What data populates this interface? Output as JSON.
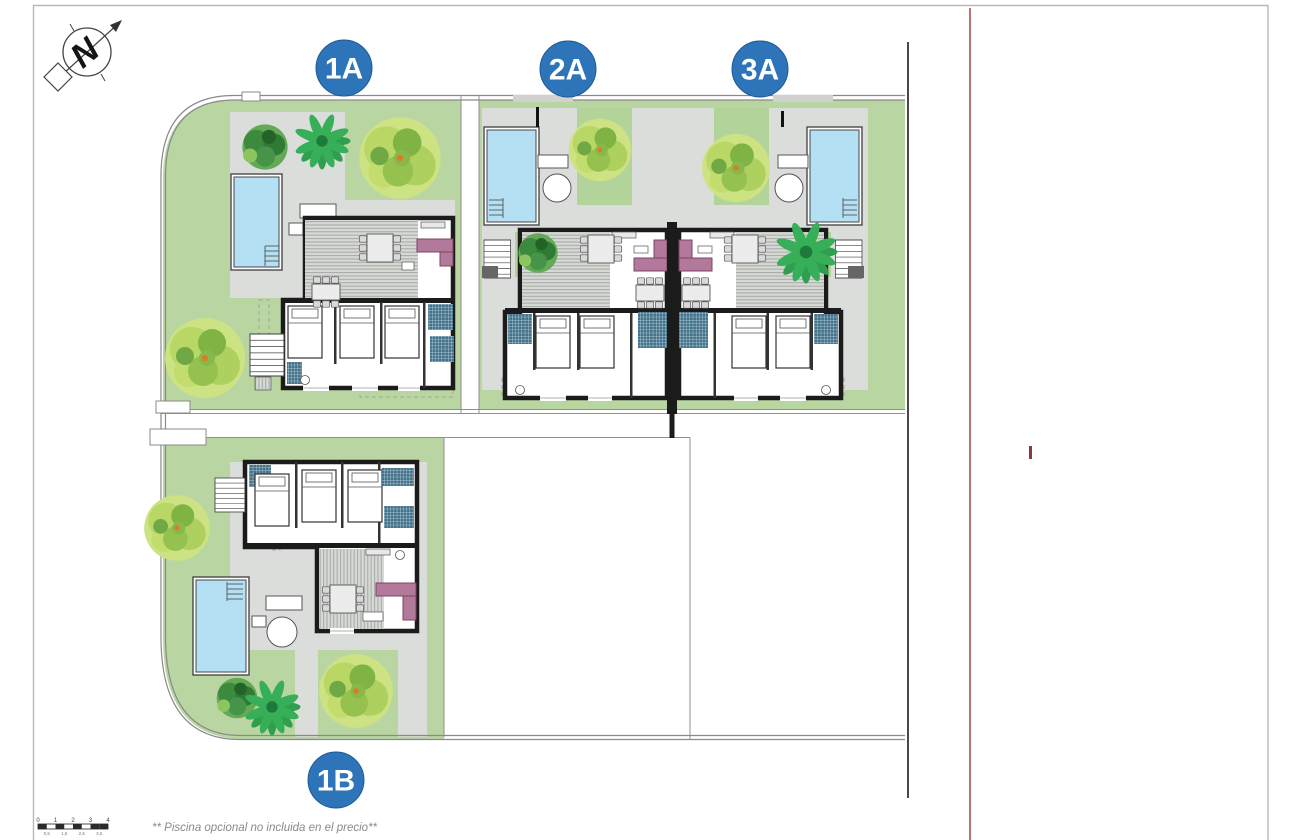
{
  "plan": {
    "compass_letter": "N",
    "badges": [
      {
        "id": "1A",
        "label": "1A"
      },
      {
        "id": "2A",
        "label": "2A"
      },
      {
        "id": "3A",
        "label": "3A"
      },
      {
        "id": "1B",
        "label": "1B"
      }
    ],
    "footer_note": "** Piscina opcional no incluida en el precio**",
    "scale_bar": {
      "top_labels": [
        "0",
        "1",
        "2",
        "3",
        "4"
      ],
      "bottom_labels": [
        "0,5",
        "1,5",
        "2,5",
        "3,5"
      ]
    },
    "colors": {
      "badge_blue": "#2e74b8",
      "lawn_green": "#b9d6a2",
      "pool_water": "#b5e0f3",
      "deck_gray": "#dbdddb",
      "wall_black": "#1b1b1b",
      "sofa_plum": "#b3799a",
      "red_boundary_line": "#c17571",
      "tree_light_green": "#cde283",
      "tree_dark_green": "#3c8a3e"
    }
  }
}
